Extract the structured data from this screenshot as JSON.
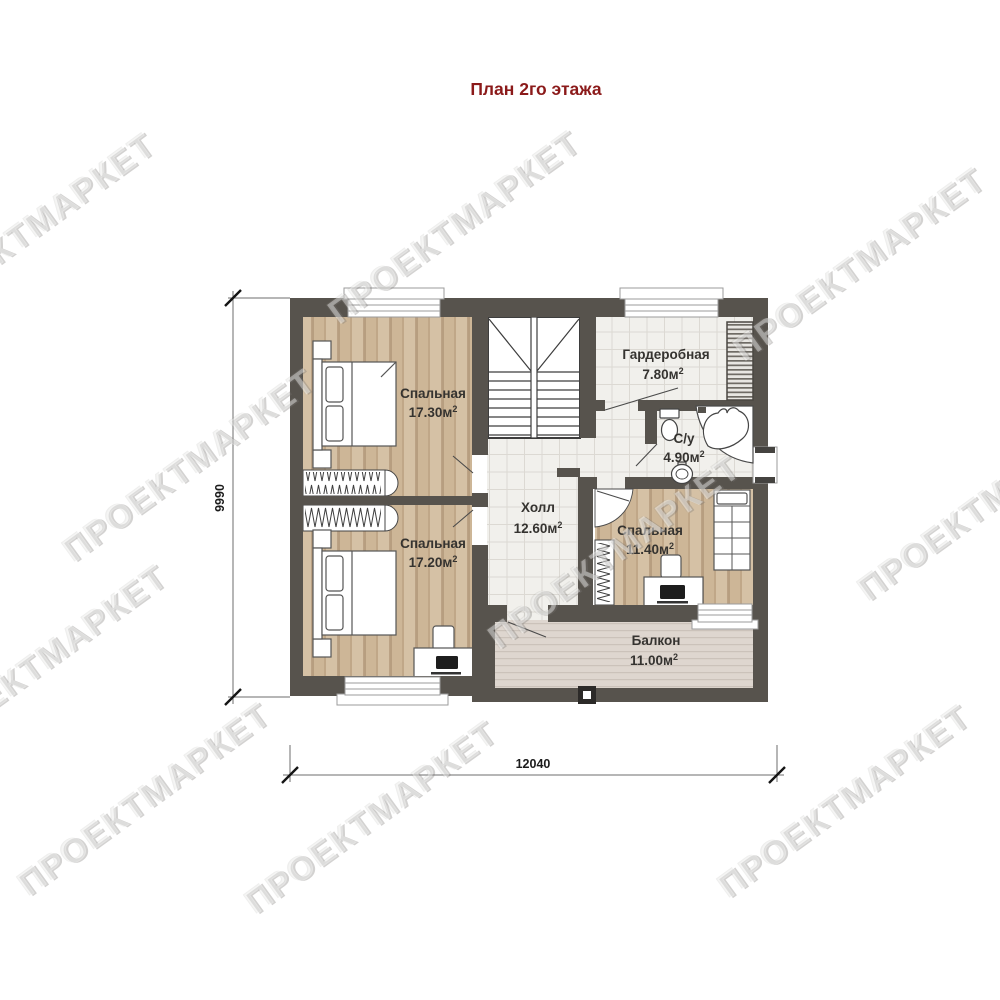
{
  "title": "План 2го этажа",
  "watermark": "ПРОЕКТМАРКЕТ",
  "plan": {
    "rooms": [
      {
        "id": "bedroom-1",
        "name": "Спальная",
        "area": "17.30м",
        "area_sup": "2"
      },
      {
        "id": "bedroom-2",
        "name": "Спальная",
        "area": "17.20м",
        "area_sup": "2"
      },
      {
        "id": "hall",
        "name": "Холл",
        "area": "12.60м",
        "area_sup": "2"
      },
      {
        "id": "wardrobe",
        "name": "Гардеробная",
        "area": "7.80м",
        "area_sup": "2"
      },
      {
        "id": "bathroom",
        "name": "С/у",
        "area": "4.90м",
        "area_sup": "2"
      },
      {
        "id": "bedroom-3",
        "name": "Спальная",
        "area": "11.40м",
        "area_sup": "2"
      },
      {
        "id": "balcony",
        "name": "Балкон",
        "area": "11.00м",
        "area_sup": "2"
      }
    ],
    "dimensions": {
      "overall_width_mm": "12040",
      "overall_height_mm": "9990"
    }
  },
  "colors": {
    "title": "#8b1a1a",
    "wall": "#57534d",
    "wood_floor": "#cdb697",
    "tile_floor": "#f1f0ec",
    "balcony_floor": "#ded6cf",
    "watermark_grey": "#dedede"
  }
}
